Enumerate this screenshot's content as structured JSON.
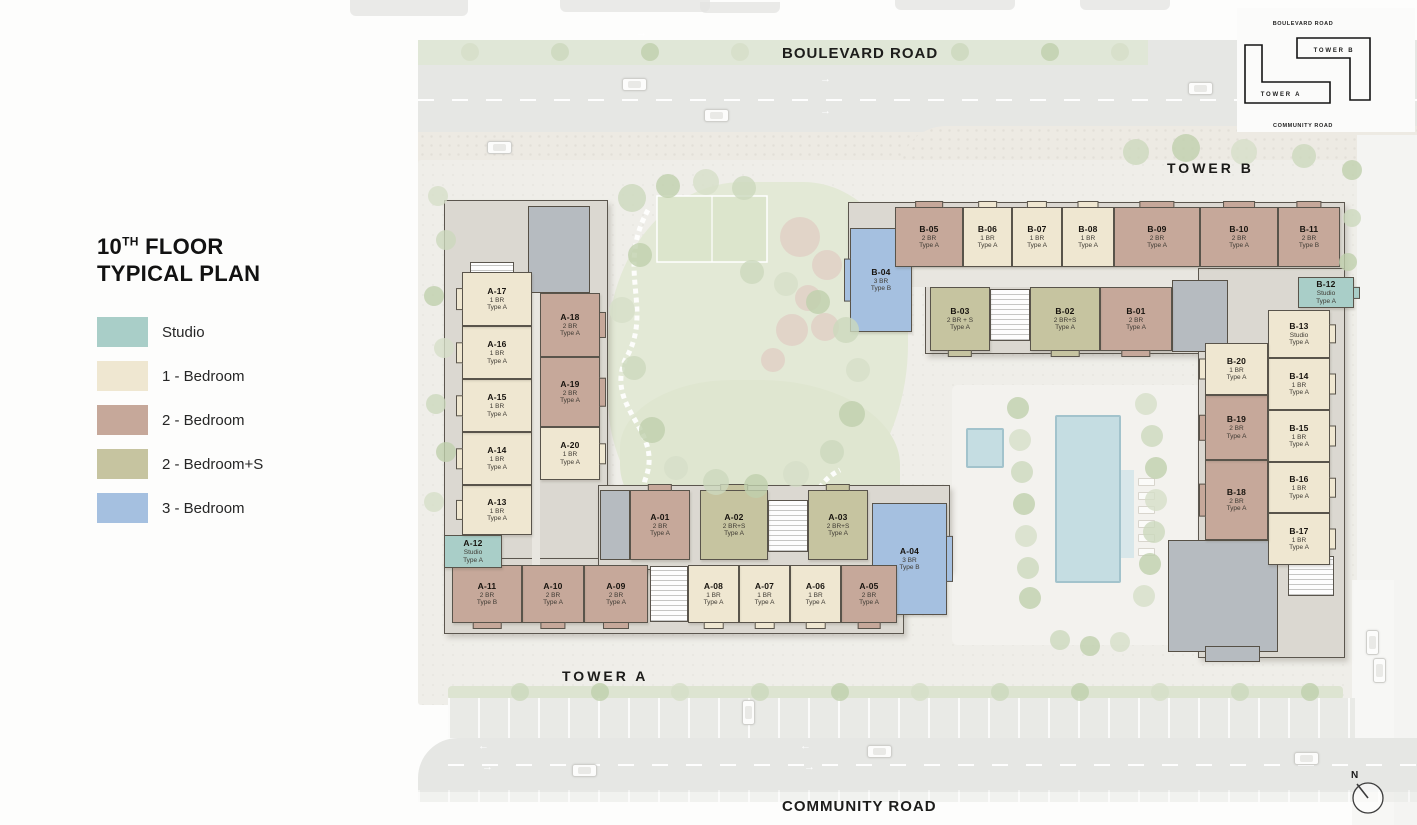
{
  "title": {
    "num": "10",
    "sup": "TH",
    "rest": " FLOOR",
    "line2": "TYPICAL PLAN"
  },
  "legend": [
    {
      "label": "Studio",
      "type": "studio"
    },
    {
      "label": "1 - Bedroom",
      "type": "br1"
    },
    {
      "label": "2 - Bedroom",
      "type": "br2"
    },
    {
      "label": "2 - Bedroom+S",
      "type": "br2s"
    },
    {
      "label": "3 - Bedroom",
      "type": "br3"
    }
  ],
  "colors": {
    "studio": "#a9cec8",
    "br1": "#efe7d1",
    "br2": "#c6a89a",
    "br2s": "#c6c4a0",
    "br3": "#a5c0e0",
    "unit_border": "#59544b"
  },
  "roads": {
    "top": "BOULEVARD ROAD",
    "bottom": "COMMUNITY ROAD"
  },
  "towers": {
    "a": "TOWER A",
    "b": "TOWER B"
  },
  "keyplan": {
    "top": "BOULEVARD ROAD",
    "bottom": "COMMUNITY ROAD",
    "tower_a": "TOWER A",
    "tower_b": "TOWER B"
  },
  "compass": {
    "label": "N"
  },
  "units": [
    {
      "id": "A-01",
      "lines": [
        "2 BR",
        "Type A"
      ],
      "type": "br2",
      "x": 630,
      "y": 490,
      "w": 60,
      "h": 70,
      "bal": "T"
    },
    {
      "id": "A-02",
      "lines": [
        "2 BR+S",
        "Type A"
      ],
      "type": "br2s",
      "x": 700,
      "y": 490,
      "w": 68,
      "h": 70,
      "bal": "T"
    },
    {
      "id": "A-03",
      "lines": [
        "2 BR+S",
        "Type A"
      ],
      "type": "br2s",
      "x": 808,
      "y": 490,
      "w": 60,
      "h": 70,
      "bal": "T"
    },
    {
      "id": "A-04",
      "lines": [
        "3 BR",
        "Type B"
      ],
      "type": "br3",
      "x": 872,
      "y": 503,
      "w": 75,
      "h": 112,
      "bal": "R"
    },
    {
      "id": "A-05",
      "lines": [
        "2 BR",
        "Type A"
      ],
      "type": "br2",
      "x": 841,
      "y": 565,
      "w": 56,
      "h": 58,
      "bal": "B"
    },
    {
      "id": "A-06",
      "lines": [
        "1 BR",
        "Type A"
      ],
      "type": "br1",
      "x": 790,
      "y": 565,
      "w": 51,
      "h": 58,
      "bal": "B"
    },
    {
      "id": "A-07",
      "lines": [
        "1 BR",
        "Type A"
      ],
      "type": "br1",
      "x": 739,
      "y": 565,
      "w": 51,
      "h": 58,
      "bal": "B"
    },
    {
      "id": "A-08",
      "lines": [
        "1 BR",
        "Type A"
      ],
      "type": "br1",
      "x": 688,
      "y": 565,
      "w": 51,
      "h": 58,
      "bal": "B"
    },
    {
      "id": "A-09",
      "lines": [
        "2 BR",
        "Type A"
      ],
      "type": "br2",
      "x": 584,
      "y": 565,
      "w": 64,
      "h": 58,
      "bal": "B"
    },
    {
      "id": "A-10",
      "lines": [
        "2 BR",
        "Type A"
      ],
      "type": "br2",
      "x": 522,
      "y": 565,
      "w": 62,
      "h": 58,
      "bal": "B"
    },
    {
      "id": "A-11",
      "lines": [
        "2 BR",
        "Type B"
      ],
      "type": "br2",
      "x": 452,
      "y": 565,
      "w": 70,
      "h": 58,
      "bal": "B"
    },
    {
      "id": "A-12",
      "lines": [
        "Studio",
        "Type A"
      ],
      "type": "studio",
      "x": 444,
      "y": 535,
      "w": 58,
      "h": 33,
      "bal": ""
    },
    {
      "id": "A-13",
      "lines": [
        "1 BR",
        "Type A"
      ],
      "type": "br1",
      "x": 462,
      "y": 485,
      "w": 70,
      "h": 50,
      "bal": "L"
    },
    {
      "id": "A-14",
      "lines": [
        "1 BR",
        "Type A"
      ],
      "type": "br1",
      "x": 462,
      "y": 432,
      "w": 70,
      "h": 53,
      "bal": "L"
    },
    {
      "id": "A-15",
      "lines": [
        "1 BR",
        "Type A"
      ],
      "type": "br1",
      "x": 462,
      "y": 379,
      "w": 70,
      "h": 53,
      "bal": "L"
    },
    {
      "id": "A-16",
      "lines": [
        "1 BR",
        "Type A"
      ],
      "type": "br1",
      "x": 462,
      "y": 326,
      "w": 70,
      "h": 53,
      "bal": "L"
    },
    {
      "id": "A-17",
      "lines": [
        "1 BR",
        "Type A"
      ],
      "type": "br1",
      "x": 462,
      "y": 272,
      "w": 70,
      "h": 54,
      "bal": "L"
    },
    {
      "id": "A-18",
      "lines": [
        "2 BR",
        "Type A"
      ],
      "type": "br2",
      "x": 540,
      "y": 293,
      "w": 60,
      "h": 64,
      "bal": "R"
    },
    {
      "id": "A-19",
      "lines": [
        "2 BR",
        "Type A"
      ],
      "type": "br2",
      "x": 540,
      "y": 357,
      "w": 60,
      "h": 70,
      "bal": "R"
    },
    {
      "id": "A-20",
      "lines": [
        "1 BR",
        "Type A"
      ],
      "type": "br1",
      "x": 540,
      "y": 427,
      "w": 60,
      "h": 53,
      "bal": "R"
    },
    {
      "id": "B-01",
      "lines": [
        "2 BR",
        "Type A"
      ],
      "type": "br2",
      "x": 1100,
      "y": 287,
      "w": 72,
      "h": 64,
      "bal": "B"
    },
    {
      "id": "B-02",
      "lines": [
        "2 BR+S",
        "Type A"
      ],
      "type": "br2s",
      "x": 1030,
      "y": 287,
      "w": 70,
      "h": 64,
      "bal": "B"
    },
    {
      "id": "B-03",
      "lines": [
        "2 BR + S",
        "Type A"
      ],
      "type": "br2s",
      "x": 930,
      "y": 287,
      "w": 60,
      "h": 64,
      "bal": "B"
    },
    {
      "id": "B-04",
      "lines": [
        "3 BR",
        "Type B"
      ],
      "type": "br3",
      "x": 850,
      "y": 228,
      "w": 62,
      "h": 104,
      "bal": "L"
    },
    {
      "id": "B-05",
      "lines": [
        "2 BR",
        "Type A"
      ],
      "type": "br2",
      "x": 895,
      "y": 207,
      "w": 68,
      "h": 60,
      "bal": "T"
    },
    {
      "id": "B-06",
      "lines": [
        "1 BR",
        "Type A"
      ],
      "type": "br1",
      "x": 963,
      "y": 207,
      "w": 49,
      "h": 60,
      "bal": "T"
    },
    {
      "id": "B-07",
      "lines": [
        "1 BR",
        "Type A"
      ],
      "type": "br1",
      "x": 1012,
      "y": 207,
      "w": 50,
      "h": 60,
      "bal": "T"
    },
    {
      "id": "B-08",
      "lines": [
        "1 BR",
        "Type A"
      ],
      "type": "br1",
      "x": 1062,
      "y": 207,
      "w": 52,
      "h": 60,
      "bal": "T"
    },
    {
      "id": "B-09",
      "lines": [
        "2 BR",
        "Type A"
      ],
      "type": "br2",
      "x": 1114,
      "y": 207,
      "w": 86,
      "h": 60,
      "bal": "T"
    },
    {
      "id": "B-10",
      "lines": [
        "2 BR",
        "Type A"
      ],
      "type": "br2",
      "x": 1200,
      "y": 207,
      "w": 78,
      "h": 60,
      "bal": "T"
    },
    {
      "id": "B-11",
      "lines": [
        "2 BR",
        "Type B"
      ],
      "type": "br2",
      "x": 1278,
      "y": 207,
      "w": 62,
      "h": 60,
      "bal": "T"
    },
    {
      "id": "B-12",
      "lines": [
        "Studio",
        "Type A"
      ],
      "type": "studio",
      "x": 1298,
      "y": 277,
      "w": 56,
      "h": 31,
      "bal": "R"
    },
    {
      "id": "B-13",
      "lines": [
        "Studio",
        "Type A"
      ],
      "type": "br1",
      "x": 1268,
      "y": 310,
      "w": 62,
      "h": 48,
      "bal": "R"
    },
    {
      "id": "B-14",
      "lines": [
        "1 BR",
        "Type A"
      ],
      "type": "br1",
      "x": 1268,
      "y": 358,
      "w": 62,
      "h": 52,
      "bal": "R"
    },
    {
      "id": "B-15",
      "lines": [
        "1 BR",
        "Type A"
      ],
      "type": "br1",
      "x": 1268,
      "y": 410,
      "w": 62,
      "h": 52,
      "bal": "R"
    },
    {
      "id": "B-16",
      "lines": [
        "1 BR",
        "Type A"
      ],
      "type": "br1",
      "x": 1268,
      "y": 462,
      "w": 62,
      "h": 51,
      "bal": "R"
    },
    {
      "id": "B-17",
      "lines": [
        "1 BR",
        "Type A"
      ],
      "type": "br1",
      "x": 1268,
      "y": 513,
      "w": 62,
      "h": 52,
      "bal": "R"
    },
    {
      "id": "B-18",
      "lines": [
        "2 BR",
        "Type A"
      ],
      "type": "br2",
      "x": 1205,
      "y": 460,
      "w": 63,
      "h": 80,
      "bal": "L"
    },
    {
      "id": "B-19",
      "lines": [
        "2 BR",
        "Type A"
      ],
      "type": "br2",
      "x": 1205,
      "y": 395,
      "w": 63,
      "h": 65,
      "bal": "L"
    },
    {
      "id": "B-20",
      "lines": [
        "1 BR",
        "Type A"
      ],
      "type": "br1",
      "x": 1205,
      "y": 343,
      "w": 63,
      "h": 52,
      "bal": "L"
    }
  ]
}
